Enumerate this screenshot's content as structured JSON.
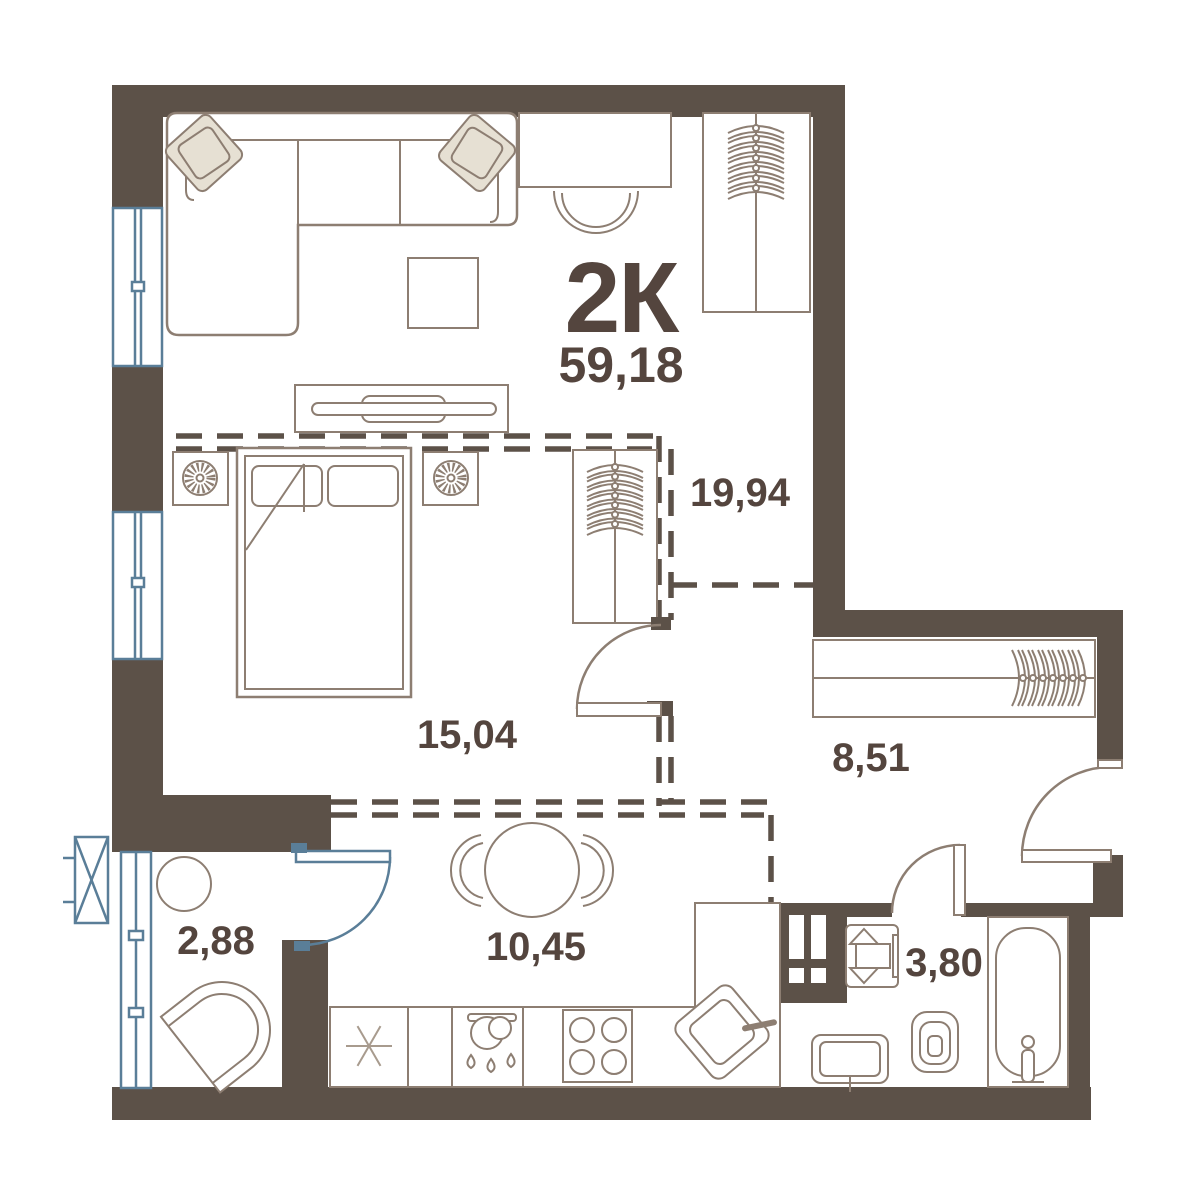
{
  "plan": {
    "title": "2К",
    "total_area": "59,18",
    "rooms": [
      {
        "id": "living-room",
        "area": "19,94",
        "furniture": [
          "corner-sofa",
          "pillows",
          "coffee-table",
          "tv-console",
          "desk",
          "desk-chair",
          "wardrobe-hangers"
        ]
      },
      {
        "id": "bedroom",
        "area": "15,04",
        "furniture": [
          "double-bed",
          "nightstand-left",
          "nightstand-right",
          "lamps",
          "wardrobe-hangers"
        ]
      },
      {
        "id": "kitchen",
        "area": "10,45",
        "furniture": [
          "dining-table",
          "two-chairs",
          "fridge-snowflake",
          "sink-with-drops",
          "stove-4-burners",
          "corner-sink",
          "l-counter"
        ]
      },
      {
        "id": "hallway",
        "area": "8,51",
        "furniture": [
          "wardrobe-hangers"
        ]
      },
      {
        "id": "bathroom",
        "area": "3,80",
        "furniture": [
          "washing-machine",
          "sink",
          "toilet",
          "bathtub",
          "vent-shaft"
        ]
      },
      {
        "id": "balcony",
        "area": "2,88",
        "furniture": [
          "round-table",
          "armchair",
          "ac-unit"
        ]
      }
    ],
    "colors": {
      "wall": "#5C5148",
      "furniture_stroke": "#8D7E72",
      "light_stroke": "#A89B8E",
      "text": "#54453E",
      "window_blue": "#5A7E98",
      "pillow_fill": "#E6E0D3",
      "background": "#FFFFFF"
    },
    "legend": {
      "dashed_lines": "optional-partition-zoning",
      "blue_elements": "windows-glazing-ac"
    }
  }
}
